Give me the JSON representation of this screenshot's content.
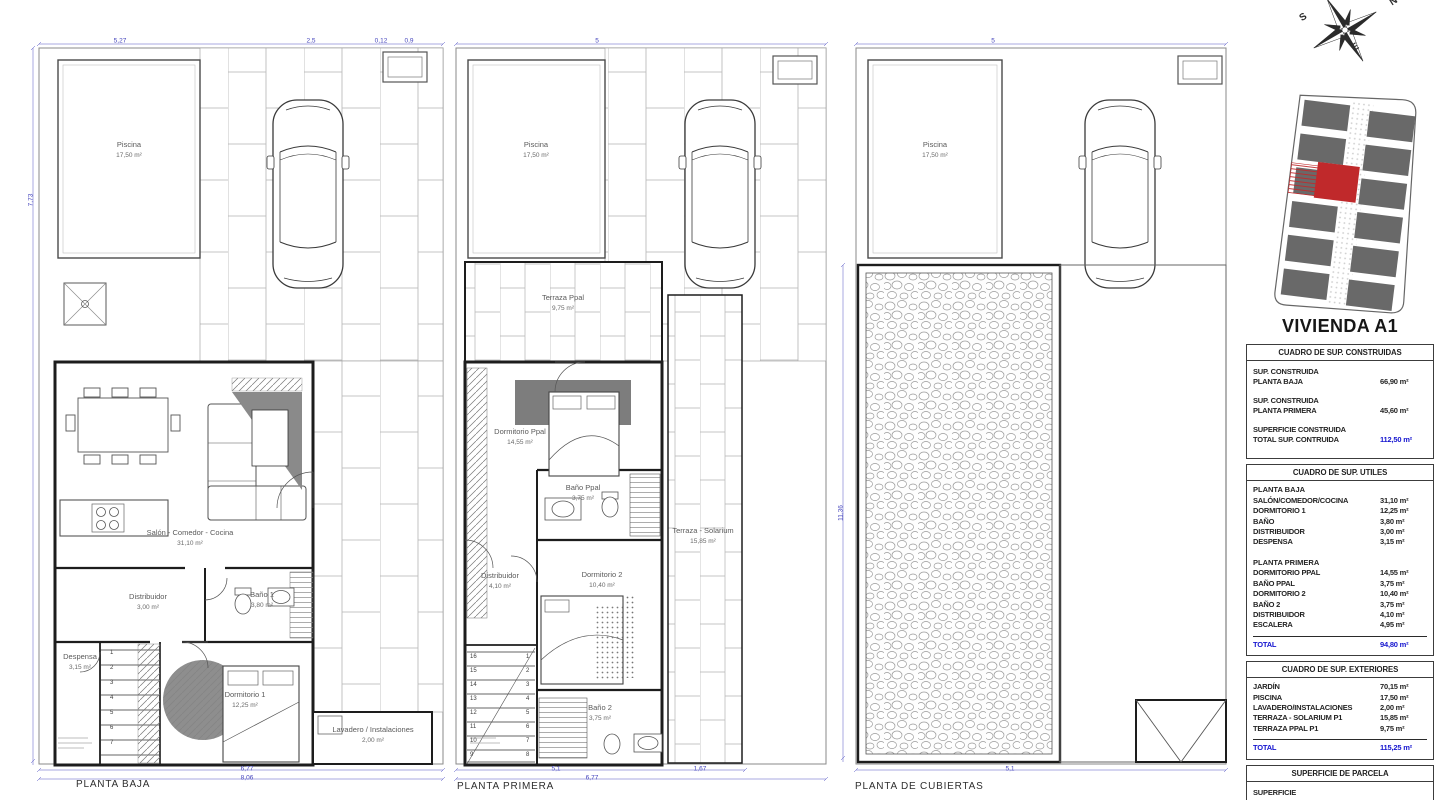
{
  "heading": "VIVIENDA A1",
  "plans": [
    {
      "id": "planta-baja",
      "title": "PLANTA BAJA",
      "rooms": [
        {
          "name": "Piscina",
          "area": "17,50 m²",
          "x": 129,
          "y": 150
        },
        {
          "name": "Salón - Comedor - Cocina",
          "area": "31,10 m²",
          "x": 190,
          "y": 538
        },
        {
          "name": "Distribuidor",
          "area": "3,00 m²",
          "x": 148,
          "y": 602
        },
        {
          "name": "Baño 1",
          "area": "3,80 m²",
          "x": 262,
          "y": 600
        },
        {
          "name": "Despensa",
          "area": "3,15 m²",
          "x": 80,
          "y": 662
        },
        {
          "name": "Dormitorio 1",
          "area": "12,25 m²",
          "x": 245,
          "y": 700
        },
        {
          "name": "Lavadero / Instalaciones",
          "area": "2,00 m²",
          "x": 373,
          "y": 735
        }
      ]
    },
    {
      "id": "planta-primera",
      "title": "PLANTA PRIMERA",
      "rooms": [
        {
          "name": "Piscina",
          "area": "17,50 m²",
          "x": 536,
          "y": 150
        },
        {
          "name": "Terraza Ppal",
          "area": "9,75 m²",
          "x": 563,
          "y": 303
        },
        {
          "name": "Dormitorio Ppal",
          "area": "14,55 m²",
          "x": 520,
          "y": 437
        },
        {
          "name": "Baño Ppal",
          "area": "3,75 m²",
          "x": 583,
          "y": 493
        },
        {
          "name": "Distribuidor",
          "area": "4,10 m²",
          "x": 500,
          "y": 581
        },
        {
          "name": "Dormitorio 2",
          "area": "10,40 m²",
          "x": 602,
          "y": 580
        },
        {
          "name": "Baño 2",
          "area": "3,75 m²",
          "x": 600,
          "y": 713
        },
        {
          "name": "Terraza - Solarium",
          "area": "15,85 m²",
          "x": 703,
          "y": 536
        }
      ]
    },
    {
      "id": "planta-cubiertas",
      "title": "PLANTA DE CUBIERTAS",
      "rooms": [
        {
          "name": "Piscina",
          "area": "17,50 m²",
          "x": 935,
          "y": 150
        }
      ]
    }
  ],
  "dimensions": [
    {
      "t": "5,27",
      "x": 120,
      "y": 41
    },
    {
      "t": "2,5",
      "x": 311,
      "y": 41
    },
    {
      "t": "0,12",
      "x": 381,
      "y": 41
    },
    {
      "t": "0,9",
      "x": 409,
      "y": 41
    },
    {
      "t": "7,73",
      "x": 31,
      "y": 200,
      "v": true
    },
    {
      "t": "6,77",
      "x": 247,
      "y": 769
    },
    {
      "t": "8,06",
      "x": 247,
      "y": 778
    },
    {
      "t": "5",
      "x": 597,
      "y": 41
    },
    {
      "t": "5,1",
      "x": 556,
      "y": 769
    },
    {
      "t": "6,77",
      "x": 592,
      "y": 778
    },
    {
      "t": "1,67",
      "x": 700,
      "y": 769
    },
    {
      "t": "5",
      "x": 993,
      "y": 41
    },
    {
      "t": "5,1",
      "x": 1010,
      "y": 769
    },
    {
      "t": "11,36",
      "x": 841,
      "y": 513,
      "v": true
    }
  ],
  "stairs": [
    {
      "x": 110,
      "y": 650,
      "step": 15,
      "nums": [
        "1",
        "2",
        "3",
        "4",
        "5",
        "6",
        "7"
      ]
    },
    {
      "x": 526,
      "y": 654,
      "step": 14,
      "nums": [
        "1",
        "2",
        "3",
        "4",
        "5",
        "6",
        "7",
        "8"
      ]
    },
    {
      "x": 470,
      "y": 654,
      "step": 14,
      "nums": [
        "16",
        "15",
        "14",
        "13",
        "12",
        "11",
        "10",
        "9"
      ]
    }
  ],
  "compass": {
    "letters": {
      "n": "N",
      "s": "S",
      "e": "E"
    }
  },
  "tables": {
    "construidas": {
      "header": "CUADRO DE SUP. CONSTRUIDAS",
      "rows": [
        {
          "lines": [
            "SUP. CONSTRUIDA",
            "PLANTA BAJA"
          ],
          "value": "66,90 m²"
        },
        {
          "lines": [
            "SUP. CONSTRUIDA",
            "PLANTA PRIMERA"
          ],
          "value": "45,60 m²"
        },
        {
          "lines": [
            "SUPERFICIE CONSTRUIDA",
            "TOTAL SUP. CONTRUIDA"
          ],
          "value": "112,50 m²",
          "accent": true
        }
      ]
    },
    "utiles": {
      "header": "CUADRO DE SUP. UTILES",
      "sections": [
        {
          "title": "PLANTA BAJA",
          "rows": [
            {
              "label": "SALÓN/COMEDOR/COCINA",
              "value": "31,10 m²"
            },
            {
              "label": "DORMITORIO 1",
              "value": "12,25 m²"
            },
            {
              "label": "BAÑO",
              "value": "3,80 m²"
            },
            {
              "label": "DISTRIBUIDOR",
              "value": "3,00 m²"
            },
            {
              "label": "DESPENSA",
              "value": "3,15 m²"
            }
          ]
        },
        {
          "title": "PLANTA PRIMERA",
          "rows": [
            {
              "label": "DORMITORIO PPAL",
              "value": "14,55 m²"
            },
            {
              "label": "BAÑO PPAL",
              "value": "3,75 m²"
            },
            {
              "label": "DORMITORIO 2",
              "value": "10,40 m²"
            },
            {
              "label": "BAÑO 2",
              "value": "3,75 m²"
            },
            {
              "label": "DISTRIBUIDOR",
              "value": "4,10 m²"
            },
            {
              "label": "ESCALERA",
              "value": "4,95 m²"
            }
          ]
        }
      ],
      "total": {
        "label": "TOTAL",
        "value": "94,80 m²"
      }
    },
    "exteriores": {
      "header": "CUADRO DE SUP. EXTERIORES",
      "sections": [
        {
          "title": "",
          "rows": [
            {
              "label": "JARDÍN",
              "value": "70,15 m²"
            },
            {
              "label": "PISCINA",
              "value": "17,50 m²"
            },
            {
              "label": "LAVADERO/INSTALACIONES",
              "value": "2,00 m²"
            },
            {
              "label": "TERRAZA - SOLARIUM P1",
              "value": "15,85 m²"
            },
            {
              "label": "TERRAZA PPAL P1",
              "value": "9,75 m²"
            }
          ]
        }
      ],
      "total": {
        "label": "TOTAL",
        "value": "115,25 m²"
      }
    },
    "parcela": {
      "header": "SUPERFICIE DE PARCELA",
      "rows": [
        {
          "lines": [
            "SUPERFICIE",
            "TOTAL DE PARCELA"
          ],
          "value": "160,11 m²",
          "accent": true
        }
      ]
    }
  },
  "colors": {
    "accent_blue": "#1414cf",
    "dim_blue": "#4646bd",
    "red_unit": "#c0292b",
    "wall": "#1d1d1d",
    "furniture_gray": "#7d7d7d"
  }
}
